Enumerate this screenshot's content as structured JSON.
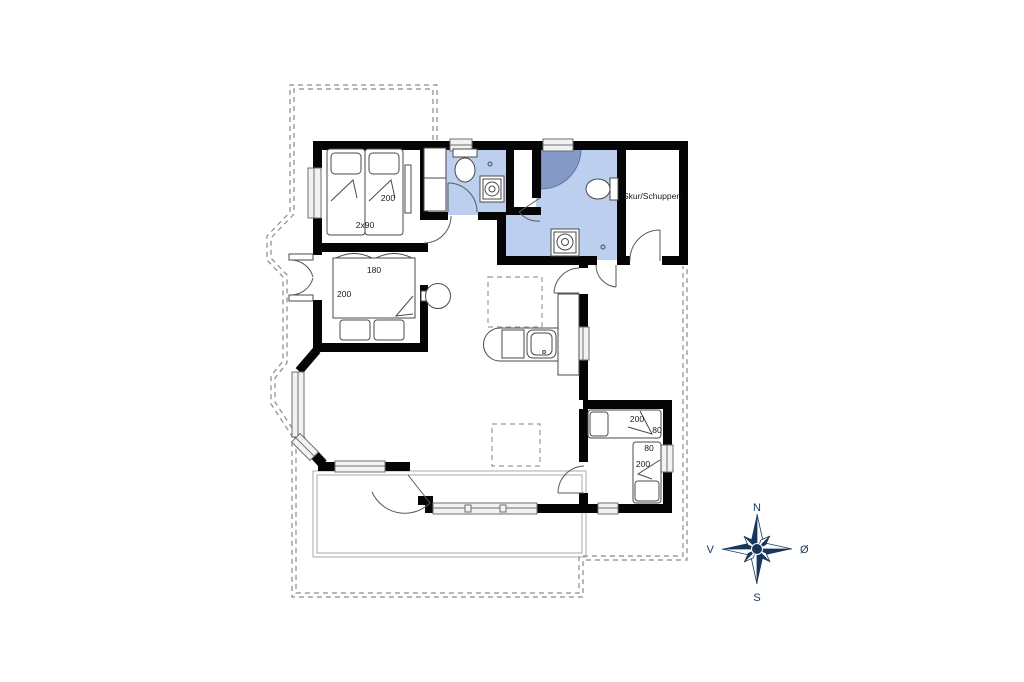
{
  "plan": {
    "shed_label": "Skur/Schuppen",
    "bedroom1": {
      "dim_length": "200",
      "dim_beds": "2x90"
    },
    "bedroom2": {
      "dim_width": "180",
      "dim_length": "200"
    },
    "bedroom3": {
      "bed_top_length": "200",
      "bed_top_width": "80",
      "bed_right_width": "80",
      "bed_right_length": "200"
    }
  },
  "compass": {
    "north": "N",
    "south": "S",
    "west": "V",
    "east": "Ø"
  },
  "colors": {
    "wall": "#050505",
    "bathroom_fill": "#bccfef",
    "shower_fill": "#8499c6",
    "compass_navy": "#16365c",
    "dashed_outline": "#8a8a8a",
    "terrace_outline": "#a8a8a8"
  }
}
